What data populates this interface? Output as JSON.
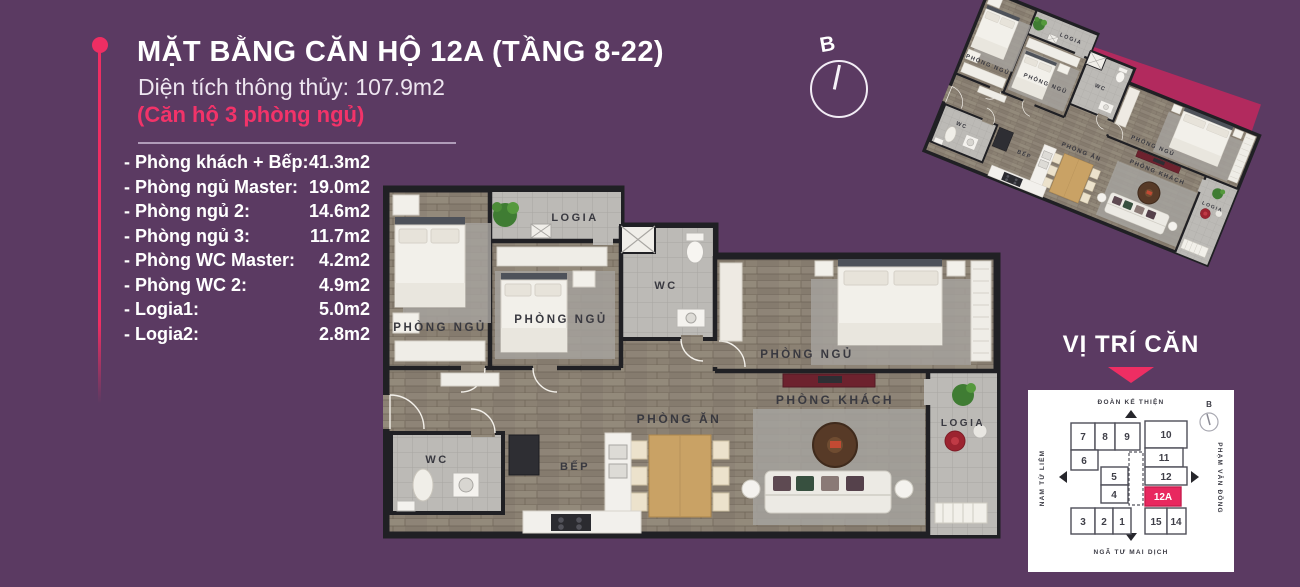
{
  "colors": {
    "background": "#5b3a62",
    "accent": "#ee2e63",
    "mini_backdrop": "#b22a5e",
    "highlight_unit": "#e8285f"
  },
  "header": {
    "title": "MẶT BẰNG CĂN HỘ 12A (TẦNG 8-22)",
    "subtitle": "Diện tích thông thủy: 107.9m2",
    "note": "(Căn hộ 3 phòng ngủ)"
  },
  "room_list": [
    {
      "label": "- Phòng khách + Bếp:",
      "value": "41.3m2"
    },
    {
      "label": "- Phòng ngủ Master:",
      "value": "19.0m2"
    },
    {
      "label": "- Phòng ngủ 2:",
      "value": "14.6m2"
    },
    {
      "label": "- Phòng ngủ 3:",
      "value": "11.7m2"
    },
    {
      "label": "- Phòng WC Master:",
      "value": "4.2m2"
    },
    {
      "label": "- Phòng WC 2:",
      "value": "4.9m2"
    },
    {
      "label": "- Logia1:",
      "value": "5.0m2"
    },
    {
      "label": "- Logia2:",
      "value": "2.8m2"
    }
  ],
  "floorplan": {
    "compass": "B",
    "labels": {
      "bedroom1": "PHÒNG NGỦ",
      "bedroom2": "PHÒNG NGỦ",
      "master": "PHÒNG NGỦ",
      "wc_master": "WC",
      "wc2": "WC",
      "living": "PHÒNG KHÁCH",
      "dining": "PHÒNG ĂN",
      "kitchen": "BẾP",
      "logia1": "LOGIA",
      "logia2": "LOGIA"
    }
  },
  "vitri": {
    "title": "VỊ TRÍ CĂN",
    "compass": "B",
    "roads": {
      "top": "ĐOÀN KẾ THIỆN",
      "right": "PHẠM VĂN ĐỒNG",
      "bottom": "NGÃ TƯ MAI DỊCH",
      "left": "NAM TỪ LIÊM"
    },
    "units": [
      "7",
      "8",
      "9",
      "10",
      "6",
      "11",
      "5",
      "12",
      "4",
      "12A",
      "3",
      "2",
      "1",
      "15",
      "14"
    ],
    "highlight": "12A"
  }
}
